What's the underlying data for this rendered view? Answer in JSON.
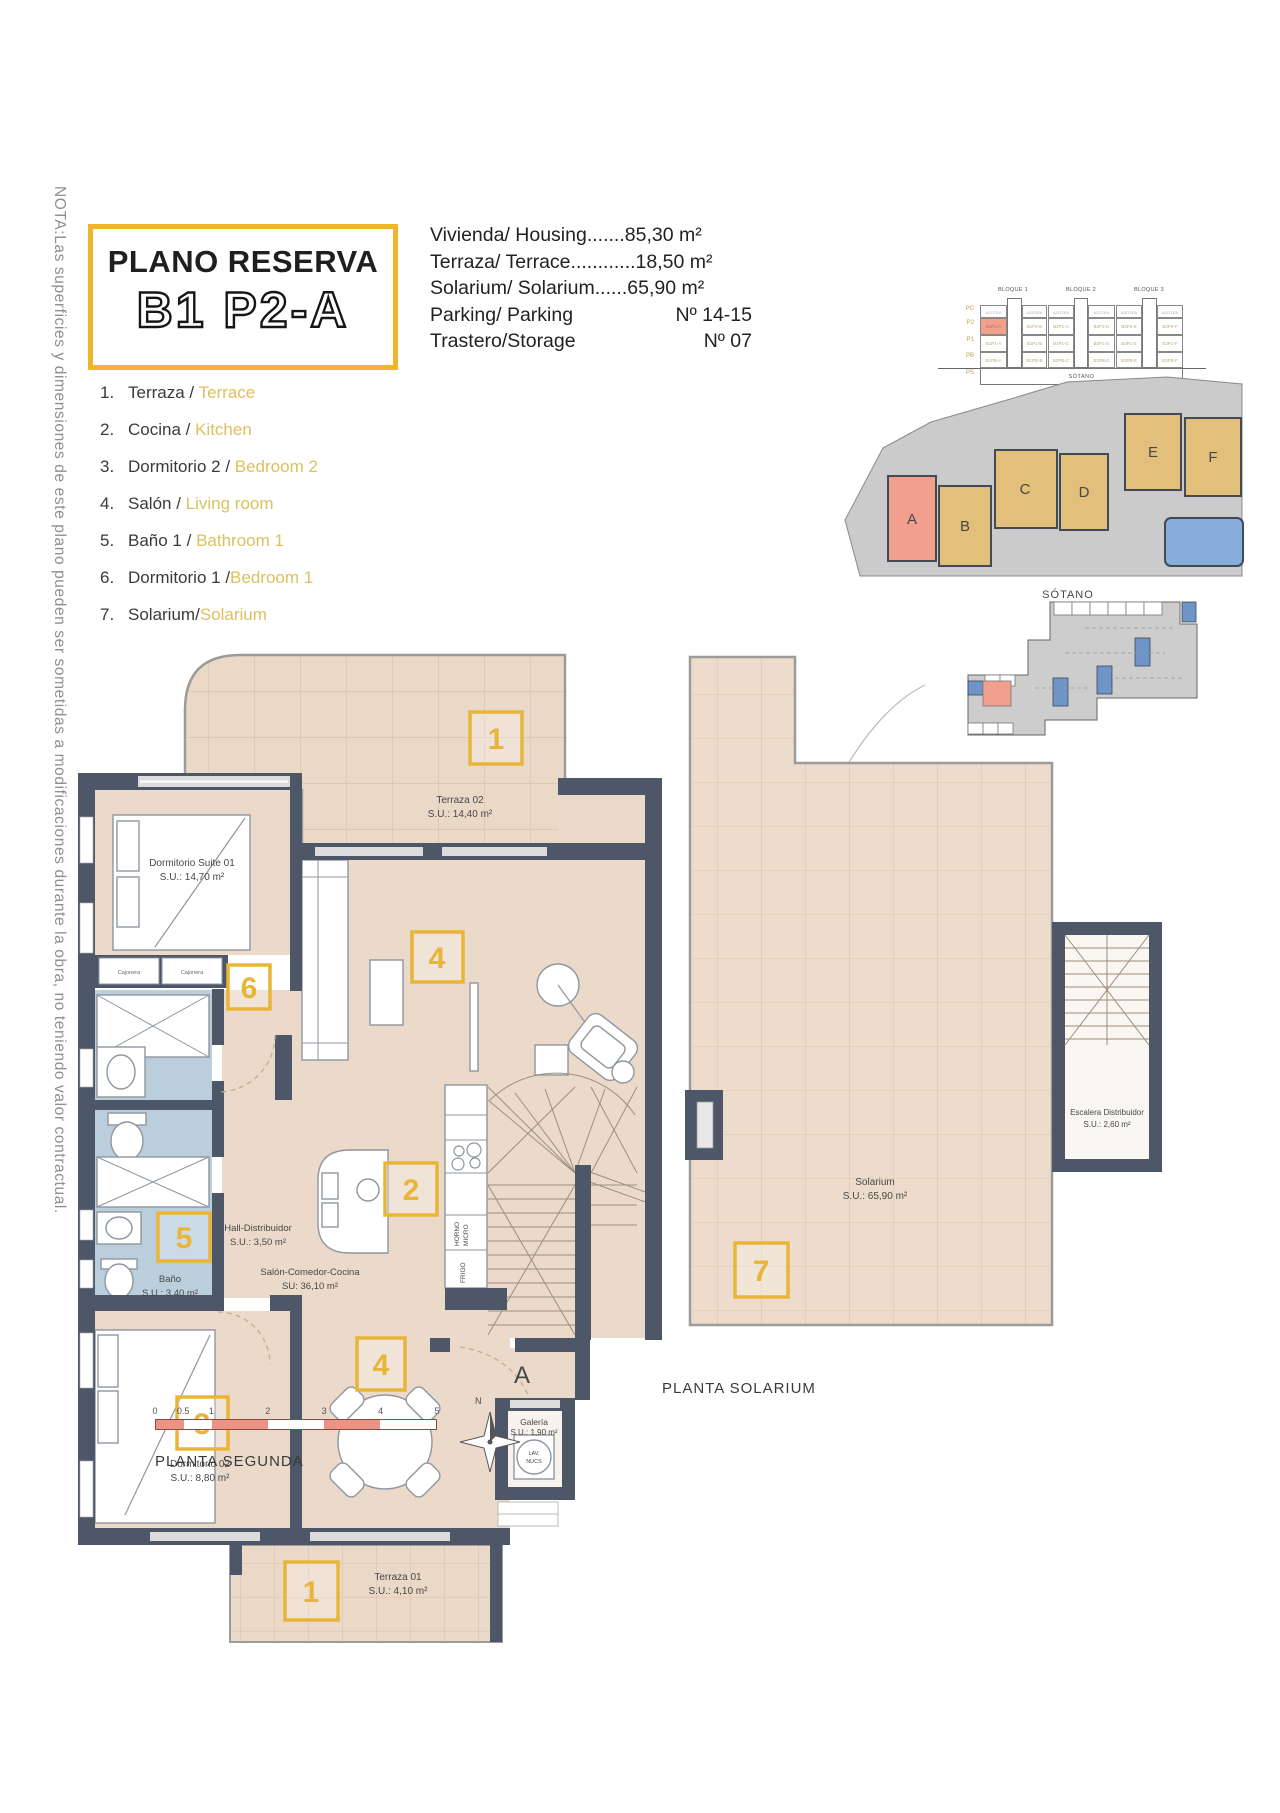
{
  "note": "NOTA:Las superficies y dimensiones de este plano pueden ser sometidas a modificaciones durante la obra, no teniendo valor contractual.",
  "title_box": {
    "line1": "PLANO RESERVA",
    "line2": "B1 P2-A"
  },
  "specs": [
    {
      "label": "Vivienda/ Housing",
      "dots": ".......",
      "value": "85,30 m²"
    },
    {
      "label": "Terraza/ Terrace",
      "dots": "............",
      "value": "18,50 m²"
    },
    {
      "label": "Solarium/ Solarium",
      "dots": "......",
      "value": "65,90 m²"
    },
    {
      "label": "Parking/ Parking",
      "value": "Nº 14-15"
    },
    {
      "label": "Trastero/Storage",
      "value": "Nº 07"
    }
  ],
  "legend": [
    {
      "num": "1.",
      "es": "Terraza",
      "sep": " / ",
      "en": "Terrace"
    },
    {
      "num": "2.",
      "es": "Cocina",
      "sep": " / ",
      "en": "Kitchen"
    },
    {
      "num": "3.",
      "es": "Dormitorio 2",
      "sep": " / ",
      "en": "Bedroom 2"
    },
    {
      "num": "4.",
      "es": "Salón",
      "sep": " / ",
      "en": "Living room"
    },
    {
      "num": "5.",
      "es": "Baño 1",
      "sep": " / ",
      "en": "Bathroom 1"
    },
    {
      "num": "6.",
      "es": "Dormitorio 1",
      "sep": " /",
      "en": "Bedroom 1"
    },
    {
      "num": "7.",
      "es": "Solarium",
      "sep": "/",
      "en": "Solarium"
    }
  ],
  "elevation": {
    "titles": [
      "BLOQUE 1",
      "BLOQUE 2",
      "BLOQUE 3"
    ],
    "floors": [
      "PC",
      "P2",
      "P1",
      "PB",
      "PS"
    ],
    "roof": "AZOTEA",
    "rows": {
      "p2": [
        "B1P2-A",
        "B1P2-B",
        "B2P2-C",
        "B2P2-D",
        "B3P2-E",
        "B3P2-F"
      ],
      "p1": [
        "B1P1-A",
        "B1P1-B",
        "B2P1-C",
        "B2P1-D",
        "B3P1-E",
        "B3P1-F"
      ],
      "pb": [
        "B1PB-A",
        "B1PB-B",
        "B2PB-C",
        "B2PB-D",
        "B3PB-E",
        "B3PB-F"
      ]
    },
    "basement": "SÓTANO"
  },
  "site_plan": {
    "letters": [
      "A",
      "B",
      "C",
      "D",
      "E",
      "F"
    ]
  },
  "sotano": {
    "label": "SÓTANO"
  },
  "plan2": {
    "caption": "PLANTA SEGUNDA",
    "terraza02": {
      "tag": "1",
      "name": "Terraza 02",
      "area": "S.U.: 14,40 m²"
    },
    "suite": {
      "tag": "6",
      "name": "Dormitorio Suite 01",
      "area": "S.U.: 14,70 m²"
    },
    "cajonera1": "Cajonera",
    "cajonera2": "Cajonera",
    "bano": {
      "tag": "5",
      "name": "Baño",
      "area": "S.U.: 3,40 m²"
    },
    "hall": {
      "name": "Hall-Distribuidor",
      "area": "S.U.: 3,50 m²"
    },
    "salon": {
      "tag_upper": "4",
      "tag_kitchen": "2",
      "tag_dining": "4",
      "name": "Salón-Comedor-Cocina",
      "area": "SU: 36,10 m²"
    },
    "horno": "HORNO",
    "micro": "MICRO",
    "frigo": "FRIGO",
    "dorm2": {
      "tag": "3",
      "name": "Dormitorio 02",
      "area": "S.U.: 8,80 m²"
    },
    "galeria": {
      "name": "Galería",
      "area": "S.U.: 1,90 m²",
      "lav1": "LAV.",
      "lav2": "NUCS"
    },
    "terraza01": {
      "tag": "1",
      "name": "Terraza 01",
      "area": "S.U.: 4,10 m²"
    },
    "entry": "A"
  },
  "solarium": {
    "caption": "PLANTA SOLARIUM",
    "tag": "7",
    "name": "Solarium",
    "area": "S.U.: 65,90 m²",
    "stairs_name": "Escalera Distribuidor",
    "stairs_area": "S.U.: 2,60 m²"
  },
  "scale": {
    "ticks": [
      "0",
      "0.5",
      "1",
      "2",
      "3",
      "4",
      "5"
    ]
  },
  "compass": {
    "n": "N"
  }
}
